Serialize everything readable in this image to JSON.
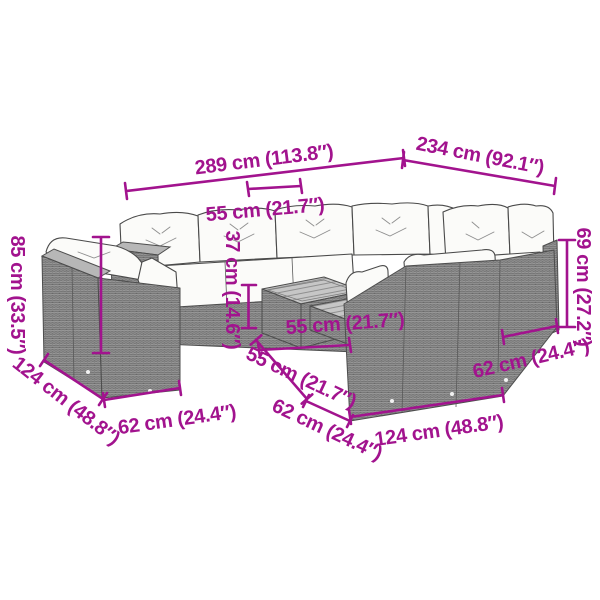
{
  "diagram": {
    "type": "product-dimension-diagram",
    "subject": "garden-lounge-set-with-coffee-table",
    "accent_color": "#a2138e",
    "wicker_color": "#8e8e8e",
    "cushion_color": "#fbfbf9"
  },
  "dimensions": {
    "total_width": "289 cm (113.8″)",
    "total_depth": "234 cm (92.1″)",
    "backrest_width": "55 cm (21.7″)",
    "table_height": "37 cm (14.6″)",
    "table_width": "55 cm (21.7″)",
    "table_depth": "55 cm (21.7″)",
    "center_seat_depth": "62 cm (24.4″)",
    "right_front_width": "124 cm (48.8″)",
    "right_seat_depth": "62 cm (24.4″)",
    "backrest_height": "69 cm (27.2″)",
    "total_height": "85 cm (33.5″)",
    "left_chair_depth": "124 cm (48.8″)",
    "left_seat_width": "62 cm (24.4″)"
  }
}
